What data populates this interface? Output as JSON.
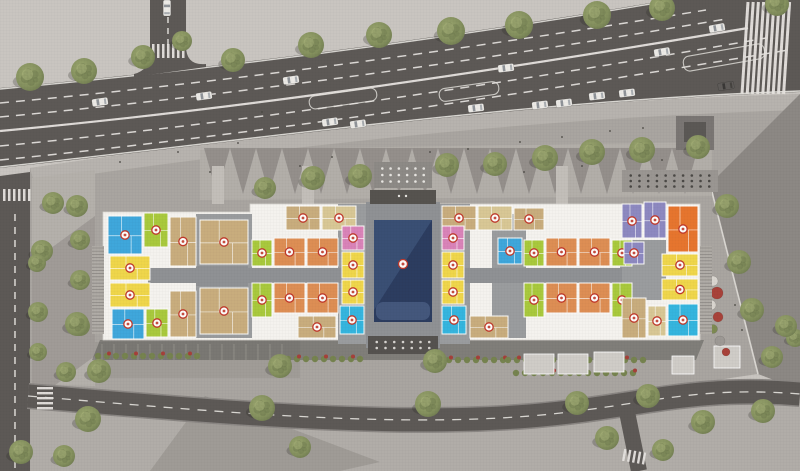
{
  "scene": {
    "canvas": {
      "w": 800,
      "h": 471
    },
    "colors": {
      "ground": "#c9c5c0",
      "ground_below": "#b1ada8",
      "plaza": "#a9a5a0",
      "plaza_light": "#b7b3ae",
      "median_strip": "#b4b0ab",
      "tri_light": "#b2aea9",
      "tri_dark": "#8e8a86",
      "right_diag": "#8c8884",
      "road": "#5d5956",
      "road_mark": "#e6e3df",
      "curb": "#d9d6d1",
      "building_white": "#f4f2ee",
      "building_edge": "#d8d5d0",
      "core_gray": "#9a9c9e",
      "corridor": "#8f9194",
      "navy": "#2c3d60",
      "navy_light": "#3d5278",
      "navy_deck": "#44577c",
      "canopy": "#56534f",
      "badge": "#c0392b",
      "hedge": "#76834f",
      "shrub_red": "#a5403a",
      "planter": "#cfccc7",
      "tree_mid": "#8a9465",
      "tree_dark": "#6e7a4e",
      "tree_light": "#aab37c",
      "utility": "#7a7673",
      "utility_dark": "#5b5855"
    },
    "unit_palette": {
      "blue": "#3fa7db",
      "cyan": "#35b5de",
      "lime": "#a9c93d",
      "tan": "#c8ad7d",
      "khaki": "#d8c795",
      "yellow": "#efd64b",
      "orange": "#dd8e54",
      "orange2": "#e6752e",
      "pink": "#d983b8",
      "purple": "#8d89c0"
    },
    "ground_regions": {
      "below_bottom_road": "M0,386 C200,410 420,432 560,414 C660,402 706,386 800,392 L800,471 L0,471 Z",
      "plaza": "M30,168 C260,134 520,102 800,94 L800,98 L710,184 L758,374 C700,382 650,392 560,412 C380,426 200,408 30,388 Z",
      "top_sidewalk": "M30,168 C260,134 520,102 800,94 L800,110 C520,118 260,150 34,182 Z",
      "right_diag": "M710,184 L800,94 L800,390 L758,374 Z",
      "corner_tr": "M752,0 L800,0 L800,38 Z",
      "median_strip": "M32,178 L95,170 L95,386 L32,384 Z",
      "median_shadow": "M32,262 L95,216 L95,356 L32,402 Z",
      "tri_strip": "M200,150 L712,142 L712,196 L200,200 Z",
      "parking_area": "M95,342 L300,340 L300,378 L95,378 Z",
      "building_shadow": "M100,340 L704,340 L696,360 L92,360 Z",
      "bottom_shadow": "M150,471 L205,396 L380,462 L340,471 Z"
    },
    "roads": {
      "main_poly": "M0,88 C240,66 470,34 668,0 L800,0 L800,92 C520,102 260,140 0,168 Z",
      "main_edge_top": "M0,89 C240,67 470,35 668,1",
      "main_edge_bottom": "M0,167 C260,139 520,101 800,91",
      "main_lanes_dashed": [
        "M0,103 C240,81 480,47 706,10",
        "M0,117 C245,94 490,59 726,19",
        "M0,146 C250,122 510,83 766,38",
        "M0,160 C250,135 520,95 788,50"
      ],
      "main_median": "M0,131 C250,108 500,70 748,28",
      "vert_poly": "M150,0 L150,52 Q150,70 134,74 L134,77 L206,67 L206,64 Q186,66 186,46 L186,0 Z",
      "vert_dash": "M168,6 L168,48",
      "left_poly": "M0,176 L30,172 L30,471 L0,471 Z",
      "left_dash": "M15,214 L15,471",
      "bottom_center": "M28,396 C200,410 380,428 530,416 C640,407 690,385 800,394",
      "bottom_width": 23,
      "branch": "M626,407 L639,471",
      "branch_width": 16,
      "turn_pockets": [
        [
          309,
          92,
          68,
          13,
          -8
        ],
        [
          439,
          85,
          60,
          13,
          -8
        ],
        [
          683,
          50,
          82,
          15,
          -10
        ]
      ]
    },
    "building": {
      "base": "M103,212 L250,212 L250,204 L700,204 L700,340 L103,340 Z",
      "cores": [
        [
          196,
          214,
          56,
          124
        ],
        [
          338,
          204,
          30,
          140
        ],
        [
          440,
          204,
          30,
          140
        ],
        [
          492,
          214,
          34,
          124
        ],
        [
          620,
          240,
          46,
          60
        ]
      ],
      "corridors": [
        [
          148,
          268,
          194,
          15
        ],
        [
          464,
          268,
          158,
          15
        ],
        [
          196,
          266,
          52,
          20
        ]
      ],
      "courtyard": {
        "frame": [
          366,
          202,
          74,
          146
        ],
        "pool": [
          374,
          220,
          58,
          102
        ],
        "deck": [
          376,
          302,
          54,
          18
        ],
        "badge": [
          403,
          264
        ]
      },
      "canopy": [
        370,
        190,
        66,
        14
      ],
      "stairs": [
        [
          92,
          246,
          12,
          88
        ],
        [
          700,
          246,
          12,
          88
        ]
      ],
      "walks": [
        [
          212,
          166,
          12,
          38
        ],
        [
          302,
          166,
          12,
          38
        ],
        [
          556,
          166,
          12,
          38
        ]
      ],
      "pergolas": [
        {
          "x": 374,
          "y": 162,
          "w": 58,
          "h": 26,
          "bg": "#8d8a86",
          "dot": "#e8e6e2",
          "cols": 6,
          "rows": 3
        },
        {
          "x": 622,
          "y": 170,
          "w": 96,
          "h": 22,
          "bg": "#9a9692",
          "dot": "#4a4845",
          "cols": 10,
          "rows": 3
        },
        {
          "x": 368,
          "y": 336,
          "w": 70,
          "h": 18,
          "bg": "#55524f",
          "dot": "#d8d5d1",
          "cols": 7,
          "rows": 2
        }
      ],
      "units": [
        [
          108,
          216,
          34,
          38,
          "blue"
        ],
        [
          144,
          213,
          24,
          34,
          "lime"
        ],
        [
          170,
          217,
          26,
          49,
          "tan"
        ],
        [
          110,
          256,
          40,
          24,
          "yellow"
        ],
        [
          110,
          283,
          40,
          24,
          "yellow"
        ],
        [
          112,
          309,
          32,
          30,
          "blue"
        ],
        [
          146,
          309,
          22,
          28,
          "lime"
        ],
        [
          170,
          291,
          26,
          46,
          "tan"
        ],
        [
          200,
          220,
          48,
          44,
          "tan"
        ],
        [
          200,
          288,
          48,
          46,
          "tan"
        ],
        [
          286,
          206,
          34,
          24,
          "tan"
        ],
        [
          322,
          206,
          34,
          24,
          "khaki"
        ],
        [
          442,
          206,
          34,
          24,
          "tan"
        ],
        [
          478,
          206,
          34,
          24,
          "khaki"
        ],
        [
          514,
          208,
          30,
          22,
          "tan"
        ],
        [
          252,
          240,
          20,
          26,
          "lime"
        ],
        [
          252,
          283,
          20,
          34,
          "lime"
        ],
        [
          274,
          238,
          31,
          28,
          "orange"
        ],
        [
          307,
          238,
          31,
          28,
          "orange"
        ],
        [
          274,
          283,
          31,
          30,
          "orange"
        ],
        [
          307,
          283,
          31,
          30,
          "orange"
        ],
        [
          298,
          316,
          38,
          22,
          "tan"
        ],
        [
          342,
          226,
          22,
          24,
          "pink"
        ],
        [
          342,
          252,
          22,
          26,
          "yellow"
        ],
        [
          342,
          280,
          22,
          24,
          "yellow"
        ],
        [
          340,
          306,
          24,
          28,
          "cyan"
        ],
        [
          442,
          226,
          22,
          24,
          "pink"
        ],
        [
          442,
          252,
          22,
          26,
          "yellow"
        ],
        [
          442,
          280,
          22,
          24,
          "yellow"
        ],
        [
          442,
          306,
          24,
          28,
          "cyan"
        ],
        [
          470,
          316,
          38,
          22,
          "tan"
        ],
        [
          498,
          238,
          24,
          26,
          "blue"
        ],
        [
          524,
          240,
          20,
          26,
          "lime"
        ],
        [
          524,
          283,
          20,
          34,
          "lime"
        ],
        [
          546,
          238,
          31,
          28,
          "orange"
        ],
        [
          579,
          238,
          31,
          28,
          "orange"
        ],
        [
          546,
          283,
          31,
          30,
          "orange"
        ],
        [
          579,
          283,
          31,
          30,
          "orange"
        ],
        [
          612,
          240,
          20,
          26,
          "lime"
        ],
        [
          612,
          283,
          20,
          34,
          "lime"
        ],
        [
          622,
          204,
          20,
          34,
          "purple"
        ],
        [
          644,
          202,
          22,
          36,
          "purple"
        ],
        [
          668,
          206,
          30,
          46,
          "orange2"
        ],
        [
          624,
          242,
          20,
          22,
          "purple"
        ],
        [
          662,
          254,
          36,
          22,
          "yellow"
        ],
        [
          662,
          279,
          36,
          21,
          "yellow"
        ],
        [
          622,
          298,
          24,
          40,
          "tan"
        ],
        [
          648,
          306,
          18,
          30,
          "khaki"
        ],
        [
          668,
          304,
          30,
          32,
          "cyan"
        ]
      ]
    },
    "trees": [
      [
        30,
        77,
        14
      ],
      [
        84,
        71,
        13
      ],
      [
        143,
        57,
        12
      ],
      [
        182,
        41,
        10
      ],
      [
        233,
        60,
        12
      ],
      [
        311,
        45,
        13
      ],
      [
        379,
        35,
        13
      ],
      [
        451,
        31,
        14
      ],
      [
        519,
        25,
        14
      ],
      [
        597,
        15,
        14
      ],
      [
        662,
        8,
        13
      ],
      [
        777,
        4,
        12
      ],
      [
        265,
        188,
        11
      ],
      [
        313,
        178,
        12
      ],
      [
        360,
        176,
        12
      ],
      [
        447,
        165,
        12
      ],
      [
        495,
        164,
        12
      ],
      [
        545,
        158,
        13
      ],
      [
        592,
        152,
        13
      ],
      [
        642,
        150,
        13
      ],
      [
        698,
        147,
        12
      ],
      [
        53,
        203,
        11
      ],
      [
        77,
        206,
        11
      ],
      [
        42,
        251,
        11
      ],
      [
        80,
        240,
        10
      ],
      [
        37,
        263,
        9
      ],
      [
        80,
        280,
        10
      ],
      [
        38,
        312,
        10
      ],
      [
        80,
        326,
        10
      ],
      [
        38,
        352,
        9
      ],
      [
        66,
        372,
        10
      ],
      [
        727,
        206,
        12
      ],
      [
        739,
        262,
        12
      ],
      [
        752,
        310,
        12
      ],
      [
        772,
        357,
        11
      ],
      [
        795,
        338,
        9
      ],
      [
        77,
        324,
        12
      ],
      [
        99,
        371,
        12
      ],
      [
        88,
        419,
        13
      ],
      [
        21,
        452,
        12
      ],
      [
        64,
        456,
        11
      ],
      [
        280,
        366,
        12
      ],
      [
        262,
        408,
        13
      ],
      [
        435,
        361,
        12
      ],
      [
        428,
        404,
        13
      ],
      [
        577,
        403,
        12
      ],
      [
        648,
        396,
        12
      ],
      [
        607,
        438,
        12
      ],
      [
        663,
        450,
        11
      ],
      [
        703,
        422,
        12
      ],
      [
        763,
        411,
        12
      ],
      [
        786,
        326,
        11
      ],
      [
        300,
        447,
        11
      ]
    ],
    "cars": [
      [
        100,
        102,
        -8,
        "w"
      ],
      [
        204,
        96,
        -8,
        "w"
      ],
      [
        291,
        80,
        -8,
        "w"
      ],
      [
        330,
        122,
        -8,
        "w"
      ],
      [
        358,
        124,
        -8,
        "w"
      ],
      [
        476,
        108,
        -7,
        "w"
      ],
      [
        506,
        68,
        -7,
        "w"
      ],
      [
        540,
        105,
        -7,
        "w"
      ],
      [
        564,
        103,
        -7,
        "w"
      ],
      [
        597,
        96,
        -7,
        "w"
      ],
      [
        627,
        93,
        -7,
        "w"
      ],
      [
        662,
        52,
        -9,
        "w"
      ],
      [
        717,
        28,
        -10,
        "w"
      ],
      [
        726,
        86,
        -9,
        "d"
      ],
      [
        167,
        8,
        90,
        "w"
      ]
    ],
    "people": [
      [
        120,
        162
      ],
      [
        178,
        152
      ],
      [
        238,
        143
      ],
      [
        210,
        172
      ],
      [
        300,
        166
      ],
      [
        332,
        157
      ],
      [
        430,
        152
      ],
      [
        468,
        149
      ],
      [
        520,
        142
      ],
      [
        562,
        137
      ],
      [
        610,
        131
      ],
      [
        643,
        128
      ],
      [
        200,
        122
      ],
      [
        262,
        112
      ],
      [
        524,
        172
      ],
      [
        582,
        166
      ],
      [
        662,
        160
      ],
      [
        700,
        156
      ],
      [
        735,
        305
      ],
      [
        742,
        330
      ]
    ],
    "hedgerows": [
      [
        98,
        198,
        356
      ],
      [
        288,
        368,
        359
      ],
      [
        440,
        512,
        360
      ],
      [
        508,
        652,
        360
      ],
      [
        516,
        640,
        373
      ]
    ],
    "planters": [
      [
        524,
        354,
        30,
        20
      ],
      [
        558,
        354,
        30,
        20
      ],
      [
        594,
        352,
        30,
        20
      ],
      [
        672,
        356,
        22,
        18
      ],
      [
        714,
        346,
        26,
        22
      ]
    ],
    "bushes_right": [
      [
        713,
        281,
        5,
        "#d9d5cf"
      ],
      [
        717,
        293,
        6,
        "#a8423a"
      ],
      [
        711,
        305,
        5,
        "#d9d5cf"
      ],
      [
        718,
        317,
        5,
        "#a8423a"
      ],
      [
        713,
        329,
        4.5,
        "#7d8a52"
      ],
      [
        720,
        341,
        5,
        "#9d9995"
      ],
      [
        726,
        352,
        4,
        "#a8423a"
      ]
    ],
    "utility_block": [
      676,
      116,
      38,
      34
    ]
  }
}
